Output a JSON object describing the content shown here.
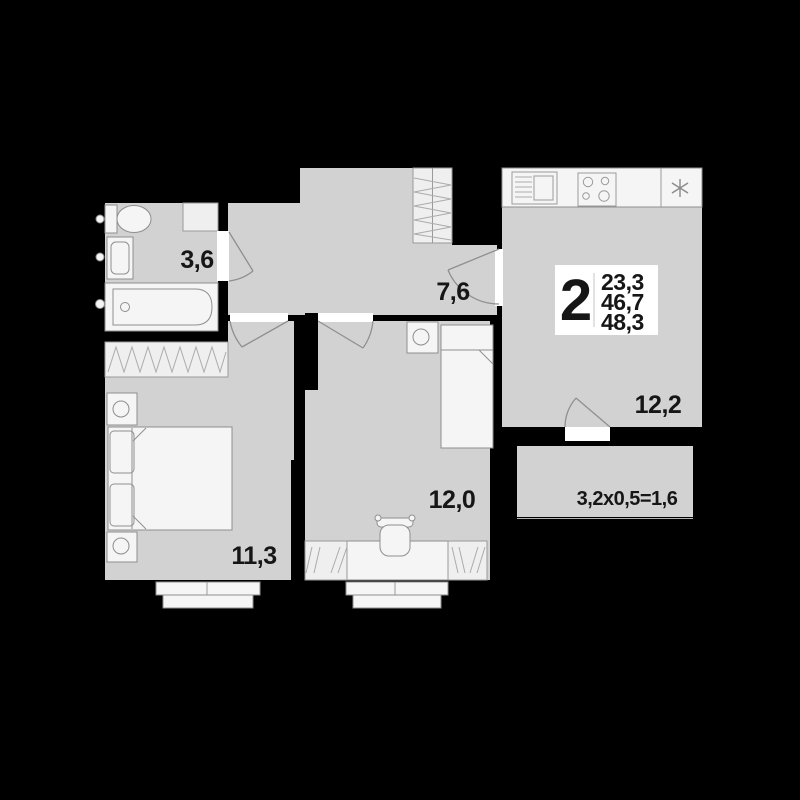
{
  "apartment": {
    "rooms_count": "2",
    "stats": [
      "23,3",
      "46,7",
      "48,3"
    ]
  },
  "rooms": {
    "bathroom": {
      "area": "3,6"
    },
    "hallway": {
      "area": "7,6"
    },
    "bedroom": {
      "area": "11,3"
    },
    "bedroom_2": {
      "area": "12,0"
    },
    "kitchen_living": {
      "area": "12,2"
    },
    "balcony": {
      "label": "3,2x0,5=1,6"
    }
  },
  "icons": {
    "fridge": "six-point-asterisk",
    "stove": "four-burner-hob",
    "kitchen_sink": "basin-with-drainer"
  },
  "colors": {
    "background": "#000000",
    "floor": "#d2d2d2",
    "fixture": "#f5f5f5",
    "outline": "#8f8f8f",
    "text": "#161616",
    "badge_bg": "#ffffff"
  }
}
